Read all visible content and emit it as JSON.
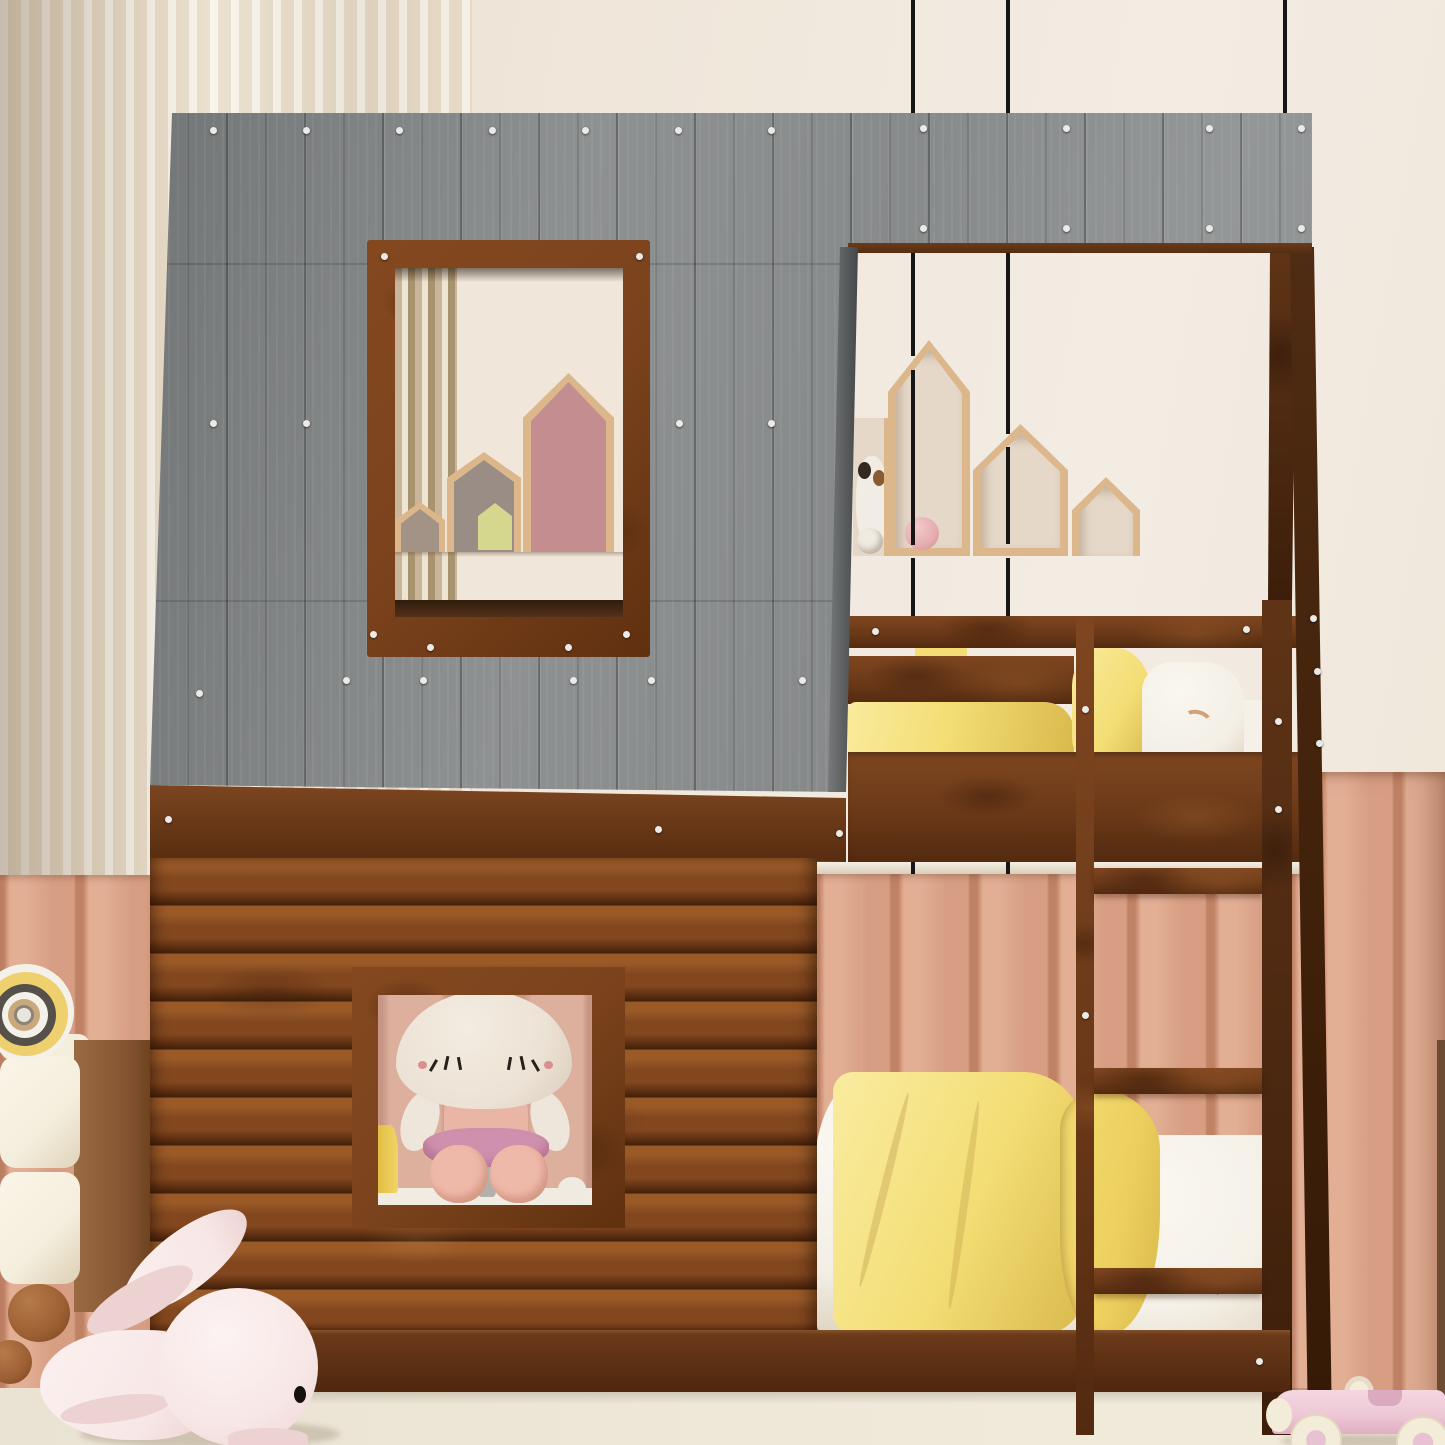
{
  "scene": {
    "type": "product-photo",
    "subject": "house-shaped twin-over-twin bunk bed with gray plank roof, rustic log-cabin facade, two windows, front ladder and A-frame post, staged in a pastel kids room",
    "objects": [
      "slat-accent-wall",
      "salmon-wainscot-panels",
      "gray-plank-roof",
      "log-cabin-wall",
      "upper-window-with-frame",
      "lower-window-with-frame",
      "house-shaped-wall-shelves",
      "upper-bunk-with-yellow-bedding",
      "lower-bunk-with-yellow-blanket",
      "wooden-ladder",
      "a-frame-post",
      "hanging-black-cables",
      "plush-mushroom-doll",
      "plush-pink-bunny",
      "plush-in-shelf",
      "pink-wooden-toy-car",
      "cream-cabinet-with-ring-toy",
      "pink-toy-ball"
    ]
  },
  "palette": {
    "wall": "#f0e6da",
    "wallTop": "#f3ece3",
    "wallShade": "#e7dbcd",
    "slatA": "#e9ddc9",
    "slatB": "#f8f3ea",
    "wainscot": "#d79e83",
    "wainscotHi": "#e2ae94",
    "wainscotLo": "#c08265",
    "wainscotWin": "#ddb09e",
    "wainscotWinLo": "#c79584",
    "roof": "#8e9192",
    "roofDark": "#737677",
    "roofEdge": "#595c5d",
    "rust": "#7b431d",
    "fasciaDark": "#542e12",
    "logHi": "#9a5a28",
    "logMid": "#82471f",
    "logLo": "#4f280e",
    "plinthA": "#6d3b1a",
    "plinthB": "#4e270e",
    "woodShelf": "#dcb78c",
    "intShadow": "#e6d8c9",
    "housePink": "#c48e91",
    "houseTaupeS": "#a29386",
    "houseTaupeM": "#998d85",
    "houseGreen": "#d5d78f",
    "yellow": "#f3dd74",
    "yellowHi": "#f9eb9c",
    "yellowLo": "#d9b94c",
    "pillowWhite": "#f3efe6",
    "sheet": "#f5f1e8",
    "rainbow": "#cfa379",
    "cable": "#161616",
    "dollCap": "#ece2d5",
    "dollSkin": "#e9b5a5",
    "dollSkirt": "#cf90ae",
    "dollLeg": "#efb9a9",
    "dollLash": "#26211a",
    "dollBlush": "#d98f8f",
    "dollGray": "#b5b1aa",
    "bunny": "#f7e7e6",
    "bunnyLo": "#ecd2d1",
    "bunnyEye": "#18120e",
    "cream": "#f4eedd",
    "cabSide": "#845432",
    "woodBall": "#9c5f34",
    "ringYellow": "#eed06e",
    "ringDark": "#55514a",
    "ringWhite": "#f4f1e8",
    "ringTan": "#c9a87e",
    "car": "#eec9d6",
    "wheel": "#f2ecd9",
    "wheelHub": "#e8c2d2",
    "floor": "#eae3d3",
    "floorHi": "#f0eadb",
    "toyBall": "#e5adb0",
    "plushDark": "#33291f",
    "plushBrown": "#8a5a33",
    "darkStrip": "#6e4c34"
  }
}
